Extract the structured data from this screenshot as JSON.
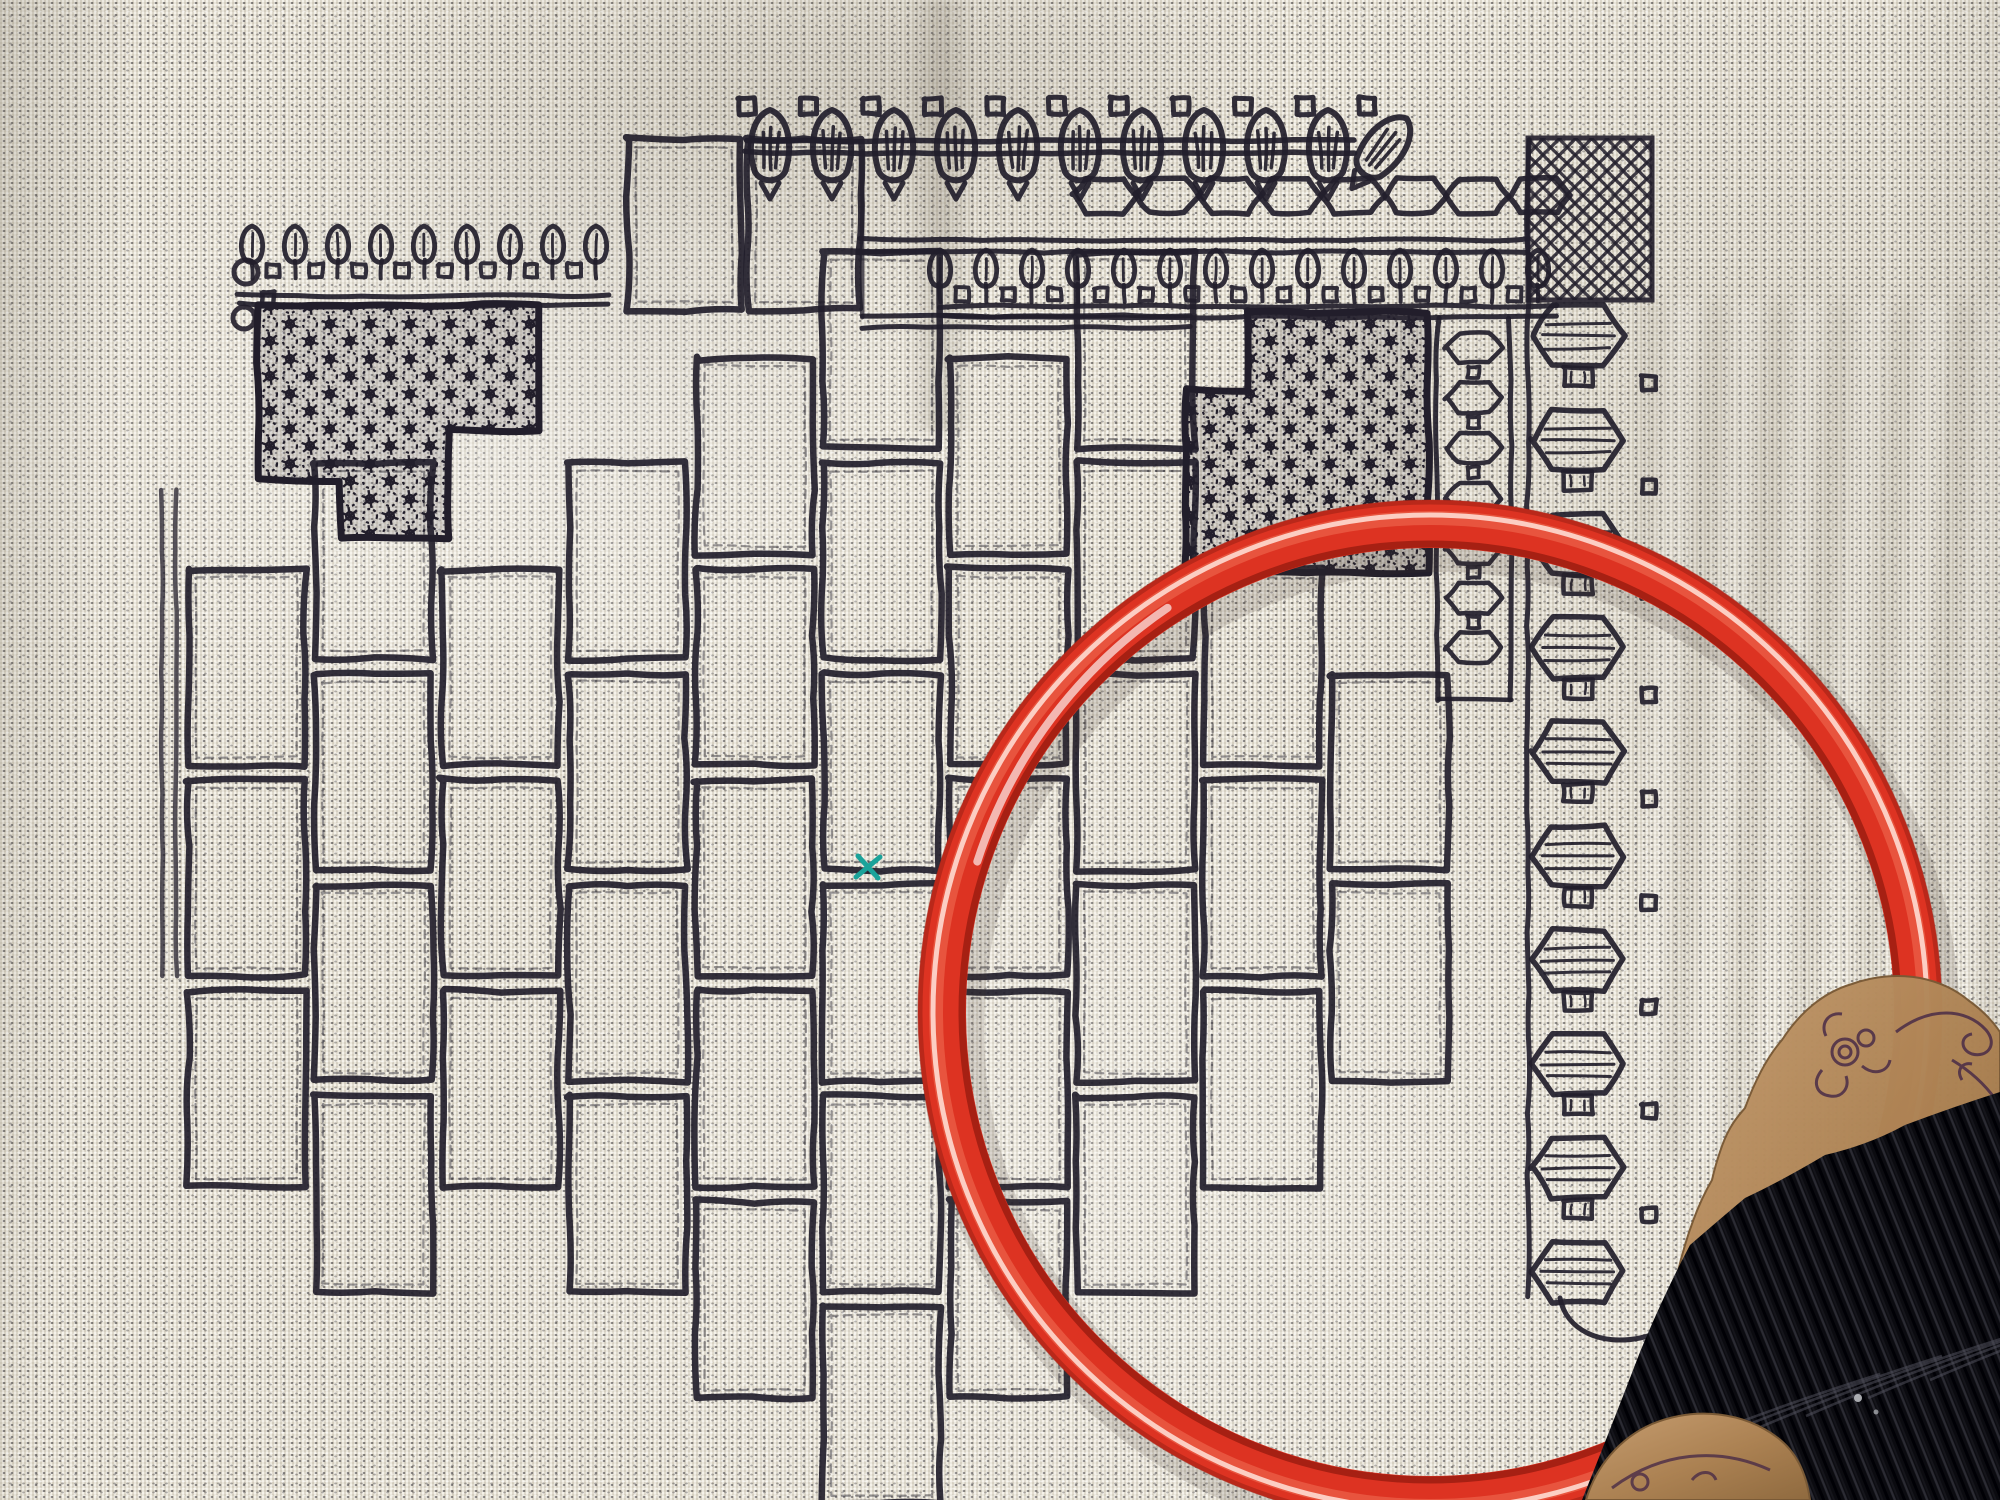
{
  "scene": {
    "description": "Blackwork embroidery sampler stitched on cream evenweave fabric, photographed with a red plastic embroidery hoop and a kraft-paper floss bobbin wound with black thread in the lower right corner",
    "objects": [
      "evenweave-fabric",
      "blackwork-embroidery",
      "red-embroidery-hoop",
      "black-floss-skein",
      "kraft-floss-card",
      "teal-marker-stitch"
    ]
  },
  "colors": {
    "fabric": "#e8e3d5",
    "stitch": "#221e2b",
    "hoop": "#dd3322",
    "hoop_mid": "#f06a52",
    "hoop_gloss": "#ffe4da",
    "hoop_dark": "#8e1d12",
    "card": "#bb9064",
    "card_print": "#4a2c47",
    "thread": "#0b0b10",
    "thread_sheen": "#2b2b33",
    "teal": "#1ba39a"
  },
  "hoop": {
    "cx": 1430,
    "cy": 1012,
    "outer_radius": 512,
    "tube_width": 48
  },
  "teal_stitch": {
    "x": 868,
    "y": 867
  },
  "card": {
    "label": "Fo"
  },
  "bricks": {
    "x0": 188,
    "col_step": 127,
    "w": 117,
    "h": 196,
    "row_step": 211,
    "odd_offset": 105,
    "y0": 147,
    "cols": 10,
    "rows": 7,
    "region": [
      [
        545,
        360
      ],
      [
        875,
        360
      ],
      [
        875,
        332
      ],
      [
        1190,
        332
      ],
      [
        1190,
        578
      ],
      [
        1448,
        578
      ],
      [
        1448,
        1002
      ],
      [
        1330,
        1150
      ],
      [
        1192,
        1302
      ],
      [
        1056,
        1434
      ],
      [
        958,
        1490
      ],
      [
        838,
        1490
      ],
      [
        698,
        1386
      ],
      [
        556,
        1292
      ],
      [
        428,
        1254
      ],
      [
        336,
        1196
      ],
      [
        244,
        1100
      ],
      [
        244,
        545
      ],
      [
        545,
        545
      ]
    ],
    "extra": [
      [
        628,
        140,
        112,
        170
      ],
      [
        748,
        140,
        112,
        170
      ]
    ]
  },
  "top_border": {
    "x0": 770,
    "leaf_step": 62,
    "count": 10,
    "tilt_leaf_x": 1382
  },
  "hex_row": {
    "x0": 1105,
    "step": 62,
    "count": 8,
    "cy": 196
  },
  "rule_lines": [
    [
      862,
      240,
      1528,
      240
    ],
    [
      862,
      252,
      1528,
      252
    ],
    [
      862,
      316,
      1190,
      316
    ],
    [
      862,
      327,
      1190,
      327
    ],
    [
      940,
      306,
      1556,
      306
    ],
    [
      940,
      317,
      1556,
      317
    ],
    [
      238,
      296,
      608,
      296
    ],
    [
      238,
      305,
      608,
      305
    ]
  ],
  "v_lines": [
    [
      862,
      150,
      862,
      318
    ],
    [
      162,
      490,
      162,
      975
    ],
    [
      176,
      490,
      176,
      975
    ]
  ],
  "bud_row_right": {
    "x0": 940,
    "step": 46,
    "count": 14,
    "top": 250
  },
  "bud_row_left": {
    "x0": 252,
    "step": 43,
    "count": 9,
    "top": 226
  },
  "corner_motif": {
    "circles": [
      [
        246,
        272,
        12
      ],
      [
        244,
        318,
        11
      ]
    ],
    "squares": [
      [
        262,
        292,
        12
      ]
    ]
  },
  "hex_strip": {
    "x_left": 1437,
    "x_right": 1511,
    "y0": 318,
    "y1": 700,
    "cy0": 348,
    "step": 50,
    "count": 7
  },
  "chain": {
    "cx": 1578,
    "cy0": 336,
    "step": 104,
    "count": 10,
    "squares_x": 1642,
    "corner": [
      1528,
      138,
      124,
      162
    ],
    "tail": "M1560,1298 C1566,1330 1600,1346 1640,1338 C1660,1334 1670,1326 1674,1316"
  },
  "dense_left": {
    "pts": [
      [
        258,
        305
      ],
      [
        540,
        305
      ],
      [
        540,
        430
      ],
      [
        448,
        430
      ],
      [
        448,
        538
      ],
      [
        340,
        538
      ],
      [
        340,
        480
      ],
      [
        258,
        480
      ]
    ]
  },
  "dense_right": {
    "pts": [
      [
        1248,
        312
      ],
      [
        1428,
        312
      ],
      [
        1428,
        572
      ],
      [
        1185,
        572
      ],
      [
        1185,
        390
      ],
      [
        1248,
        390
      ]
    ]
  },
  "thread": {
    "edge": [
      [
        1582,
        1500
      ],
      [
        1640,
        1352
      ],
      [
        1690,
        1245
      ],
      [
        1745,
        1198
      ],
      [
        1825,
        1155
      ],
      [
        1905,
        1125
      ],
      [
        2000,
        1092
      ]
    ]
  }
}
